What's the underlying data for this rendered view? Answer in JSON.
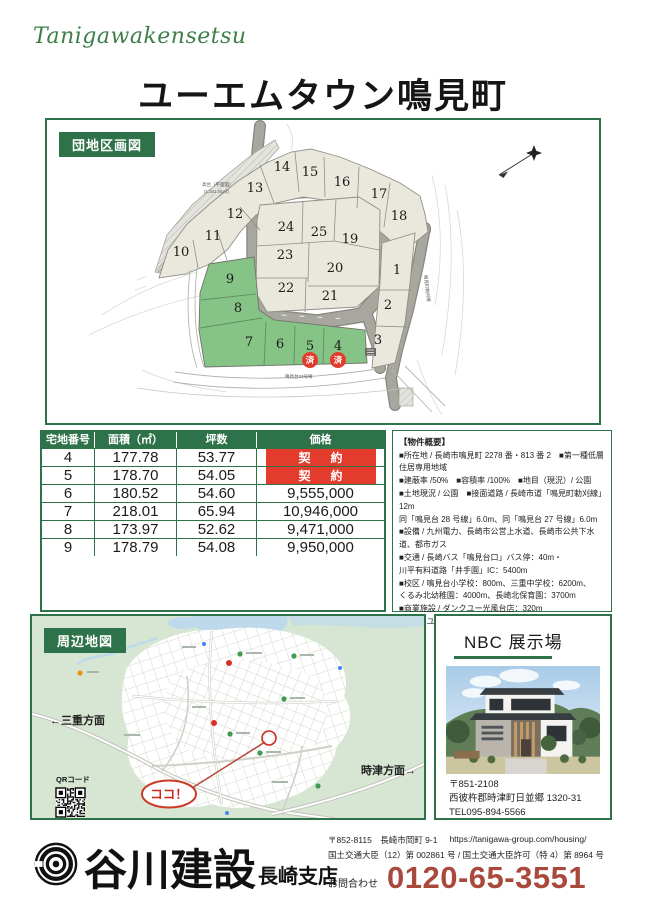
{
  "colors": {
    "green": "#2e7249",
    "badge_red": "#e33b2c",
    "phone_red": "#a8493c",
    "lot_green": "#85c486",
    "lot_beige": "#eae8dc",
    "script_green": "#3e8048"
  },
  "header": {
    "script_logo": "Tanigawakensetsu",
    "title": "ユーエムタウン鳴見町"
  },
  "site_plan": {
    "label": "団地区画図",
    "slope_label": "高台（平面図）",
    "slope_area": "(1,341.91㎡)",
    "bottom_road_label": "鳴見台23号線",
    "side_road_label": "鳴見町勅刈線",
    "sold_badge": "済",
    "lots": [
      {
        "n": "1"
      },
      {
        "n": "2"
      },
      {
        "n": "3"
      },
      {
        "n": "4",
        "sold": true
      },
      {
        "n": "5",
        "sold": true
      },
      {
        "n": "6"
      },
      {
        "n": "7"
      },
      {
        "n": "8"
      },
      {
        "n": "9"
      },
      {
        "n": "10"
      },
      {
        "n": "11"
      },
      {
        "n": "12"
      },
      {
        "n": "13"
      },
      {
        "n": "14"
      },
      {
        "n": "15"
      },
      {
        "n": "16"
      },
      {
        "n": "17"
      },
      {
        "n": "18"
      },
      {
        "n": "19"
      },
      {
        "n": "20"
      },
      {
        "n": "21"
      },
      {
        "n": "22"
      },
      {
        "n": "23"
      },
      {
        "n": "24"
      },
      {
        "n": "25"
      }
    ]
  },
  "price_table": {
    "headers": [
      "宅地番号",
      "面積（㎡）",
      "坪数",
      "価格"
    ],
    "rows": [
      {
        "no": "4",
        "area": "177.78",
        "tsubo": "53.77",
        "price": "契　約",
        "sold": true
      },
      {
        "no": "5",
        "area": "178.70",
        "tsubo": "54.05",
        "price": "契　約",
        "sold": true
      },
      {
        "no": "6",
        "area": "180.52",
        "tsubo": "54.60",
        "price": "9,555,000",
        "sold": false
      },
      {
        "no": "7",
        "area": "218.01",
        "tsubo": "65.94",
        "price": "10,946,000",
        "sold": false
      },
      {
        "no": "8",
        "area": "173.97",
        "tsubo": "52.62",
        "price": "9,471,000",
        "sold": false
      },
      {
        "no": "9",
        "area": "178.79",
        "tsubo": "54.08",
        "price": "9,950,000",
        "sold": false
      }
    ]
  },
  "property_overview": {
    "title": "【物件概要】",
    "lines": [
      "■所在地 / 長崎市鳴見町 2278 番・813 番 2　■第一種低層住居専用地域",
      "■建蔽率 /50%　■容積率 /100%　■地目（現況）/ 公園",
      "■土地現況 / 公園　■接面道路 / 長崎市道「鳴見町勅刈線」12m",
      "同「鳴見台 28 号線」6.0m、同「鳴見台 27 号線」6.0m",
      "■設備 / 九州電力、長崎市公営上水道、長崎市公共下水道、都市ガス",
      "■交通 / 長崎バス「鳴見台口」バス停：40m・",
      "川平有料道路「井手園」IC：5400m",
      "■校区 / 鳴見台小学校：800m、三重中学校：6200m、",
      "くるみ北幼稚園：4000m、長崎北保育園：3700m",
      "■商業施設 / ダンクユー光風台店：320m",
      "■売主 / ユーエム企画　■代理販売 / 谷川建設"
    ]
  },
  "area_map": {
    "label": "周辺地図",
    "direction_left": "←三重方面",
    "direction_right": "時津方面→",
    "qr_label": "QRコード",
    "here_label": "ココ！"
  },
  "exhibit": {
    "title": "NBC 展示場",
    "postal": "〒851-2108",
    "address": "西彼杵郡時津町日並郷 1320-31",
    "tel": "TEL095-894-5566"
  },
  "footer": {
    "company": "谷川建設",
    "branch": "長崎支店",
    "address_line": "〒852-8115　長崎市岡町 9-1",
    "url": "https://tanigawa-group.com/housing/",
    "license_line": "国土交通大臣（12）第 002861 号 / 国土交通大臣許可（特 4）第 8964 号",
    "contact_label": "お問合わせ",
    "phone": "0120-65-3551"
  }
}
